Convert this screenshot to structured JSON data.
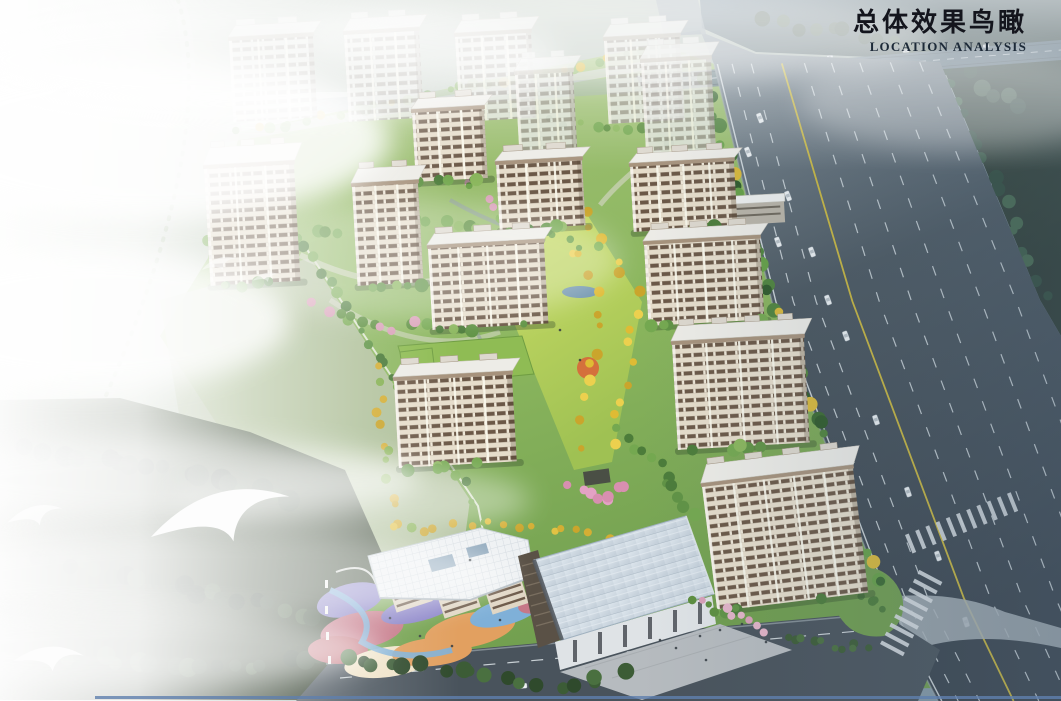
{
  "header": {
    "title_cn": "总体效果鸟瞰",
    "title_en": "LOCATION ANALYSIS"
  },
  "palette": {
    "sky_left": "#f7f9f7",
    "sky_mid": "#cdd6d0",
    "sky_right": "#8499a6",
    "haze_band": "#9fae9e",
    "forest_dark": "#35443a",
    "forest_deep": "#2a3830",
    "forest_blue": "#5c7484",
    "site_lawn": "#8bb65e",
    "site_lawn_dark": "#6f9d4e",
    "meadow_haze": "#b7c3a6",
    "axis_lawn": "#c2d75c",
    "yellow_tree": "#e5c43f",
    "green_tree": "#5d8f3f",
    "cherry_pink": "#e3a2c4",
    "accent_orange_tree": "#d4703c",
    "facade_cream": "#e6ddcb",
    "window_band": "#6b5847",
    "window_gap": "#efe8d8",
    "facade_haze": "#e3e5df",
    "window_band_haze": "#98928a",
    "roof_white": "#edece7",
    "roof_haze": "#e6e8e5",
    "roof_edge_taupe": "#a6927c",
    "roof_box": "#ddd8ce",
    "road_asphalt": "#4a565f",
    "road_dark": "#39434d",
    "road_haze": "#8a98a2",
    "cross_road": "#5f7484",
    "lane_yellow": "#d8c23a",
    "lane_white": "#dfe6ea",
    "path_light": "#d8d8cc",
    "kindergarten_roof": "#eef1f3",
    "playground_pink": "#c67888",
    "playground_purple": "#8b84c8",
    "playground_orange": "#e2a060",
    "playground_blue": "#7fb0d8",
    "playground_cream": "#f0e3c8",
    "playground_red": "#c06a74",
    "commercial_roof": "#c6d1db",
    "plaza_grey": "#b6bbbf",
    "pond_blue": "#6f94ae",
    "bird_white": "#fdfdfd",
    "bottom_edge_line": "#5f7fae"
  },
  "scene": {
    "buildings": [
      {
        "x": 229,
        "y": 40,
        "w": 84,
        "h": 82,
        "haze": 1
      },
      {
        "x": 344,
        "y": 34,
        "w": 75,
        "h": 88,
        "haze": 1
      },
      {
        "x": 455,
        "y": 36,
        "w": 76,
        "h": 86,
        "haze": 1
      },
      {
        "x": 604,
        "y": 40,
        "w": 76,
        "h": 84,
        "haze": 1
      },
      {
        "x": 641,
        "y": 62,
        "w": 70,
        "h": 96,
        "haze": 1
      },
      {
        "x": 515,
        "y": 74,
        "w": 58,
        "h": 88,
        "haze": 1
      },
      {
        "x": 412,
        "y": 112,
        "w": 72,
        "h": 70,
        "haze": 0
      },
      {
        "x": 204,
        "y": 168,
        "w": 90,
        "h": 118,
        "haze": 0
      },
      {
        "x": 352,
        "y": 186,
        "w": 66,
        "h": 100,
        "haze": 0
      },
      {
        "x": 496,
        "y": 164,
        "w": 86,
        "h": 66,
        "haze": 0
      },
      {
        "x": 630,
        "y": 166,
        "w": 104,
        "h": 66,
        "haze": 0
      },
      {
        "x": 718,
        "y": 204,
        "w": 66,
        "h": 22,
        "haze": 0,
        "low": 1
      },
      {
        "x": 644,
        "y": 244,
        "w": 116,
        "h": 82,
        "haze": 0
      },
      {
        "x": 428,
        "y": 248,
        "w": 116,
        "h": 82,
        "haze": 0
      },
      {
        "x": 672,
        "y": 344,
        "w": 132,
        "h": 106,
        "haze": 0
      },
      {
        "x": 394,
        "y": 380,
        "w": 118,
        "h": 88,
        "haze": 0
      },
      {
        "x": 702,
        "y": 486,
        "w": 152,
        "h": 126,
        "haze": 0,
        "rot": -7
      }
    ],
    "green_roofs": [
      {
        "pts": "398,346 522,336 534,374 410,386"
      },
      {
        "pts": "400,352 432,348 436,380 404,384"
      }
    ],
    "pond": {
      "cx": 580,
      "cy": 292,
      "rx": 18,
      "ry": 6
    },
    "birds": [
      {
        "x": 146,
        "y": 490,
        "s": 4.3,
        "r": -6,
        "o": 1
      },
      {
        "x": 6,
        "y": 504,
        "s": 1.7,
        "r": -4,
        "o": 0.9
      },
      {
        "x": 16,
        "y": 638,
        "s": 2.1,
        "r": 6,
        "o": 0.95
      },
      {
        "x": 200,
        "y": 258,
        "s": 1.1,
        "r": -8,
        "o": 0.5
      },
      {
        "x": 252,
        "y": 272,
        "s": 0.8,
        "r": -4,
        "o": 0.45
      },
      {
        "x": 52,
        "y": 86,
        "s": 0.7,
        "r": 0,
        "o": 0.4
      }
    ],
    "cars_highway": [
      [
        760,
        118,
        69
      ],
      [
        748,
        152,
        69
      ],
      [
        788,
        196,
        69
      ],
      [
        778,
        242,
        70
      ],
      [
        812,
        252,
        70
      ],
      [
        828,
        300,
        70
      ],
      [
        846,
        336,
        70
      ],
      [
        876,
        420,
        71
      ],
      [
        908,
        492,
        71
      ],
      [
        938,
        556,
        71
      ],
      [
        966,
        622,
        72
      ]
    ],
    "cars_cross_road": [
      [
        830,
        57,
        -4
      ],
      [
        906,
        51,
        -4
      ],
      [
        986,
        46,
        -4
      ]
    ],
    "cars_bottom_road": [
      [
        522,
        686,
        -5
      ],
      [
        648,
        668,
        -5
      ]
    ]
  }
}
